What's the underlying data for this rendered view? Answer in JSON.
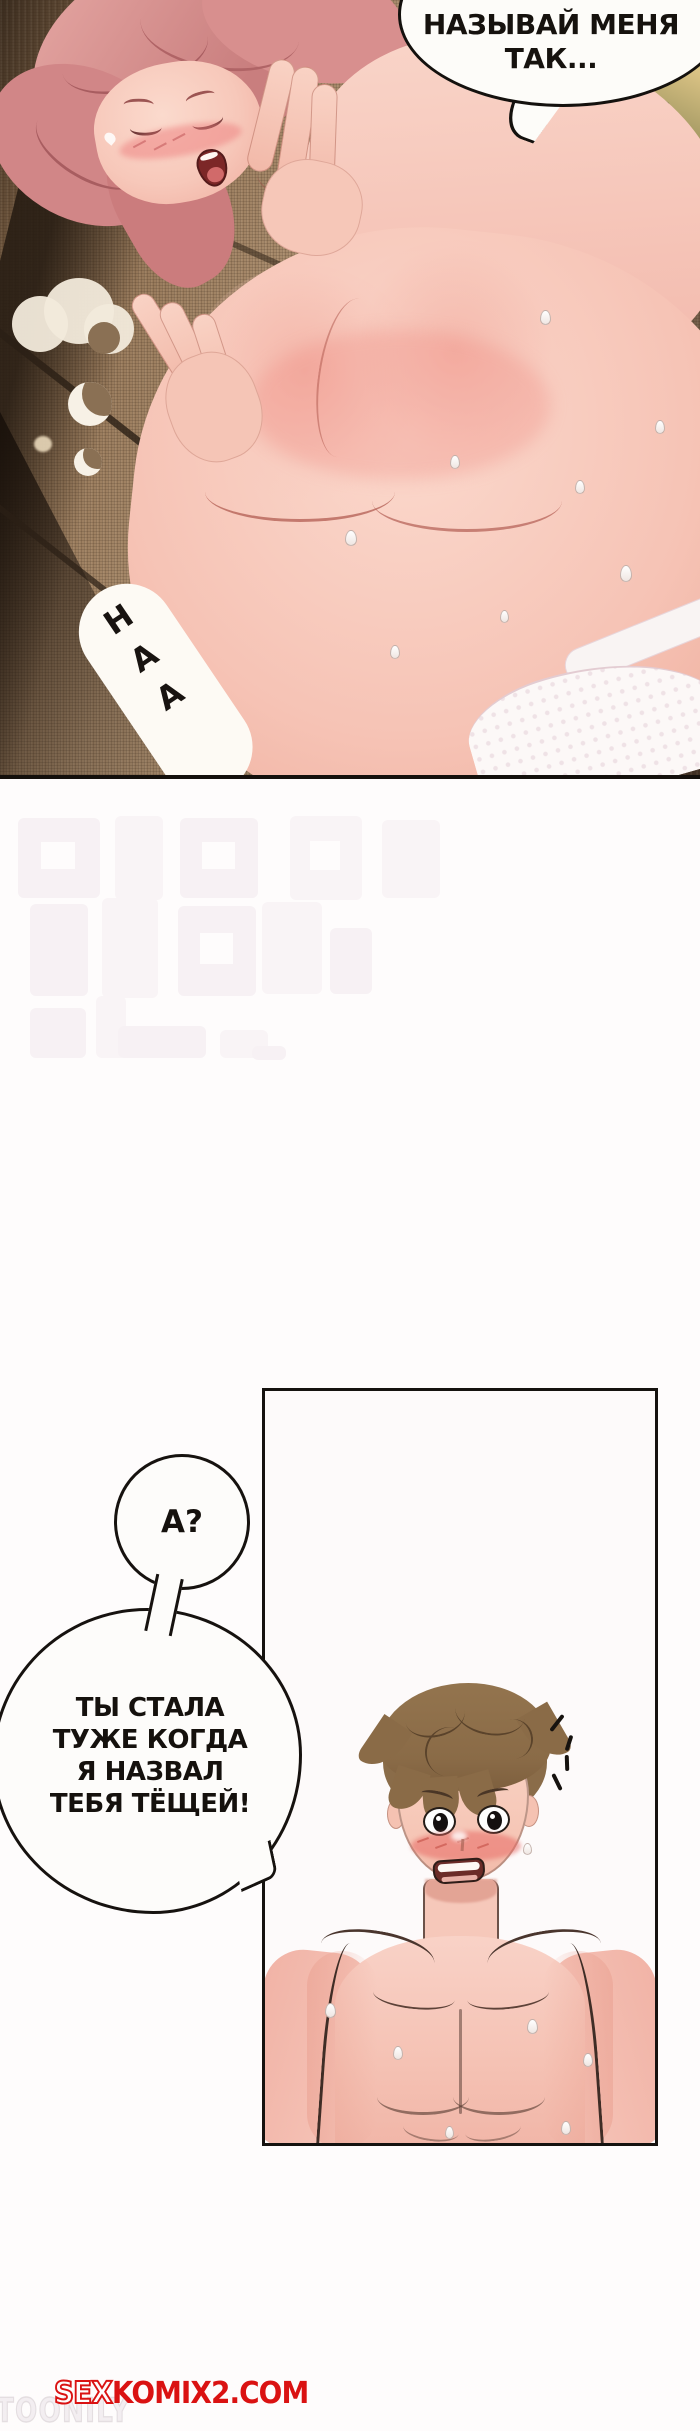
{
  "page": {
    "width_px": 700,
    "height_px": 2431
  },
  "panel_1": {
    "speech_bubble": {
      "lines": [
        "НАЗЫВАЙ МЕНЯ",
        "ТАК..."
      ]
    },
    "moan_bubble": {
      "text": "НАА"
    }
  },
  "panel_2": {
    "small_bubble": {
      "text": "А?"
    },
    "large_bubble": {
      "lines": [
        "ТЫ СТАЛА",
        "ТУЖЕ КОГДА",
        "Я НАЗВАЛ",
        "ТЕБЯ ТЁЩЕЙ!"
      ]
    }
  },
  "watermarks": {
    "site": {
      "prefix": "SEX",
      "rest": "KOMIX2.COM",
      "color": "#da1212"
    },
    "scanlator": {
      "text": "TOONILY"
    }
  },
  "colors": {
    "page_background": "#fefcfc",
    "panel_border": "#16120f",
    "couch_brown": "#97795a",
    "skin": "#f6c6ba",
    "hair_pink": "#d18687",
    "hair_brown": "#8a6b47",
    "blush_red": "#e76a64",
    "watermark_red": "#da1212"
  }
}
